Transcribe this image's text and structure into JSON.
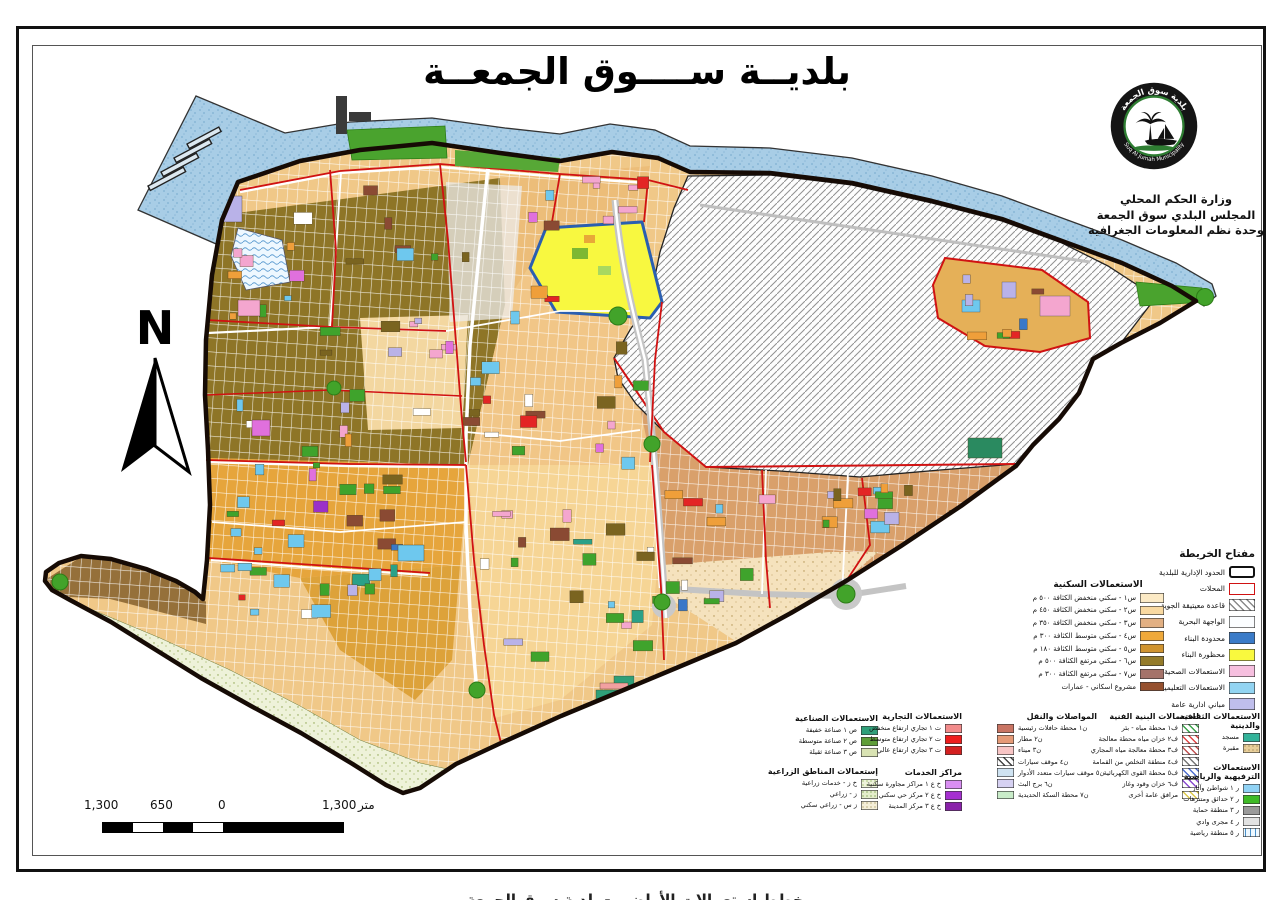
{
  "title": "بلديــة ســــوق الجمعــة",
  "logo": {
    "ring_text_top": "بلدية سوق الجمعة",
    "ring_text_bottom": "Suq Al Jumah Municipality"
  },
  "org": {
    "lines": [
      "وزارة الحكم المحلي",
      "المجلس البلدي سوق الجمعة",
      "وحدة نظم المعلومات الجغرافية"
    ]
  },
  "north_label": "N",
  "scale_bar": {
    "labels": [
      "1,300",
      "650",
      "0",
      "1,300"
    ],
    "unit": "متر"
  },
  "bottom_caption": "مخطط استعمالات الأراضي - بلدية سوق الجمعة",
  "map_colors": {
    "sea": "#a8cde6",
    "boundary": "#160b05",
    "quarter_line": "#d01212",
    "restricted_yellow": "#f8f840",
    "limited_blue": "#2b5fb0",
    "patch_palette": [
      "#6ec8ee",
      "#f4a6cf",
      "#3fa32c",
      "#b9b2e8",
      "#e070dd",
      "#e32525",
      "#8a4a33",
      "#7a6420",
      "#ffffff",
      "#2aa188",
      "#3a78c8",
      "#9b30c8",
      "#ef9f3a"
    ],
    "patch_weights": [
      20,
      12,
      17,
      6,
      4,
      6,
      8,
      6,
      6,
      3,
      3,
      2,
      7
    ]
  },
  "legend": {
    "key": {
      "title": "مفتاح الخريطة",
      "items": [
        {
          "label": "الحدود الإدارية للبلدية",
          "sw": {
            "t": "thick",
            "c": "#111111"
          }
        },
        {
          "label": "المحلات",
          "sw": {
            "t": "outline",
            "c": "#d01212"
          }
        },
        {
          "label": "قاعدة معيتيقة الجوية",
          "sw": {
            "t": "hatch",
            "c": "#8a8a8a"
          }
        },
        {
          "label": "الواجهة البحرية",
          "sw": {
            "t": "fill",
            "c": "#fbfdff"
          }
        },
        {
          "label": "محدودة البناء",
          "sw": {
            "t": "fill",
            "c": "#3a7bc8"
          }
        },
        {
          "label": "محظورة البناء",
          "sw": {
            "t": "fill",
            "c": "#f9f93e"
          }
        },
        {
          "label": "الاستعمالات الصحية",
          "sw": {
            "t": "fill",
            "c": "#f6bfdf"
          }
        },
        {
          "label": "الاستعمالات التعليمية",
          "sw": {
            "t": "fill",
            "c": "#92d4f2"
          }
        },
        {
          "label": "مباني ادارية عامة",
          "sw": {
            "t": "fill",
            "c": "#bfbeec"
          }
        }
      ]
    },
    "residential": {
      "title": "الاستعمالات السكنية",
      "items": [
        {
          "label": "س١ - سكني منخفض الكثافة ٥٠٠ م",
          "sw": {
            "t": "fill",
            "c": "#fceac5"
          }
        },
        {
          "label": "س٢ - سكني منخفض الكثافة ٤٥٠ م",
          "sw": {
            "t": "fill",
            "c": "#f9d9a1"
          }
        },
        {
          "label": "س٣ - سكني منخفض الكثافة ٣٥٠ م",
          "sw": {
            "t": "fill",
            "c": "#e2b083"
          }
        },
        {
          "label": "س٤ - سكني متوسط الكثافة ٣٠٠ م",
          "sw": {
            "t": "fill",
            "c": "#efa93b"
          }
        },
        {
          "label": "س٥ - سكني متوسط الكثافة ١٨٠ م",
          "sw": {
            "t": "fill",
            "c": "#d09430"
          }
        },
        {
          "label": "س٦ - سكني مرتفع الكثافة ٥٠٠ م",
          "sw": {
            "t": "fill",
            "c": "#947b2a"
          }
        },
        {
          "label": "س٧ - سكني مرتفع الكثافة ٣٠٠ م",
          "sw": {
            "t": "fill",
            "c": "#a5736a"
          }
        },
        {
          "label": "مشروع اسكاني - عمارات",
          "sw": {
            "t": "fill",
            "c": "#96512f"
          }
        }
      ]
    },
    "industrial": {
      "title": "الاستعمالات الصناعية",
      "items": [
        {
          "label": "ص ١  صناعة خفيفة",
          "sw": {
            "t": "fill",
            "c": "#2f9f79"
          }
        },
        {
          "label": "ص ٢  صناعة متوسطة",
          "sw": {
            "t": "fill",
            "c": "#5f9e38"
          }
        },
        {
          "label": "ص ٣  صناعة ثقيلة",
          "sw": {
            "t": "fill",
            "c": "#d9e3b3"
          }
        }
      ]
    },
    "agriculture": {
      "title": "إستعمالات المناطق الزراعية",
      "items": [
        {
          "label": "خ ز - خدمات زراعية",
          "sw": {
            "t": "stipple",
            "c": "#eef3da",
            "d": "#7aa83c"
          }
        },
        {
          "label": "ز - زراعي",
          "sw": {
            "t": "stipple",
            "c": "#e4eecb",
            "d": "#5c8c2c"
          }
        },
        {
          "label": "ز س - زراعي سكني",
          "sw": {
            "t": "stipple",
            "c": "#f5efd8",
            "d": "#9a8a4a"
          }
        }
      ]
    },
    "commercial": {
      "title": "الاستعمالات التجارية",
      "items": [
        {
          "label": "ت ١ تجاري ارتفاع منخفض",
          "sw": {
            "t": "fill",
            "c": "#f28b8b"
          }
        },
        {
          "label": "ت ٢ تجاري ارتفاع متوسط",
          "sw": {
            "t": "fill",
            "c": "#ee1c1c"
          }
        },
        {
          "label": "ت ٣ تجاري ارتفاع عالي",
          "sw": {
            "t": "fill",
            "c": "#d42020"
          }
        }
      ]
    },
    "services": {
      "title": "مراكز الخدمات",
      "items": [
        {
          "label": "خ ع ١  مراكز مجاورة سكنية",
          "sw": {
            "t": "fill",
            "c": "#d98ef2"
          }
        },
        {
          "label": "خ ع ٢  مركز حي سكني",
          "sw": {
            "t": "fill",
            "c": "#a52fd0"
          }
        },
        {
          "label": "خ ع ٣  مركز المدينة",
          "sw": {
            "t": "fill",
            "c": "#8a22aa"
          }
        }
      ]
    },
    "transport": {
      "title": "المواصلات والنقل",
      "swatch_left": true,
      "items": [
        {
          "label": "ن١ محطة حافلات رئيسية",
          "sw": {
            "t": "fill",
            "c": "#c97463"
          }
        },
        {
          "label": "ن٢ مطار",
          "sw": {
            "t": "fill",
            "c": "#e59a77"
          }
        },
        {
          "label": "ن٣ ميناء",
          "sw": {
            "t": "fill",
            "c": "#f8c5c5"
          }
        },
        {
          "label": "ن٤ موقف سيارات",
          "sw": {
            "t": "hatch",
            "c": "#444444"
          }
        },
        {
          "label": "ن٥ موقف سيارات متعدد الأدوار",
          "sw": {
            "t": "fill",
            "c": "#cfe3f2"
          }
        },
        {
          "label": "ن٦ برج البث",
          "sw": {
            "t": "fill",
            "c": "#d6d1f2"
          }
        },
        {
          "label": "ن٧ محطة السكة الحديدية",
          "sw": {
            "t": "fill",
            "c": "#c9ecc9"
          }
        }
      ]
    },
    "infrastructure": {
      "title": "استعمالات البنية الفنية",
      "items": [
        {
          "label": "ف١  محطة مياه - بئر",
          "sw": {
            "t": "hatch",
            "c": "#3aa34a"
          }
        },
        {
          "label": "ف٢  خزان مياه محطة معالجة",
          "sw": {
            "t": "hatch",
            "c": "#e04444"
          }
        },
        {
          "label": "ف٣ محطة معالجة مياه المجاري",
          "sw": {
            "t": "hatch",
            "c": "#c05050"
          }
        },
        {
          "label": "ف٤ منطقة التخلص من القمامة",
          "sw": {
            "t": "hatch",
            "c": "#787878"
          }
        },
        {
          "label": "ف٥ محطة القوى الكهربائية",
          "sw": {
            "t": "hatch",
            "c": "#4f6fd0"
          }
        },
        {
          "label": "ف٦ خزان وقود وغاز",
          "sw": {
            "t": "hatch",
            "c": "#8a4ad0"
          }
        },
        {
          "label": "مرافق عامة أخرى",
          "sw": {
            "t": "hatch",
            "c": "#ddca4a"
          }
        }
      ]
    },
    "cultural": {
      "title": "الاستعمالات الثقافية والدينية",
      "items": [
        {
          "label": "مسجد",
          "sw": {
            "t": "fill",
            "c": "#33b39a"
          }
        },
        {
          "label": "مقبرة",
          "sw": {
            "t": "stipple",
            "c": "#e9cf9a",
            "d": "#8a7340"
          }
        }
      ]
    },
    "recreation": {
      "title": "الاستعمالات الترفيهية والرياضية",
      "items": [
        {
          "label": "ر ١  شواطئ وآثار",
          "sw": {
            "t": "fill",
            "c": "#90d2f4"
          }
        },
        {
          "label": "ر ٢  حدائق ومتنزهات",
          "sw": {
            "t": "fill",
            "c": "#3fbb27"
          }
        },
        {
          "label": "ر ٣  منطقة حماية",
          "sw": {
            "t": "fill",
            "c": "#9a9a9a"
          }
        },
        {
          "label": "ر ٤  مجرى وادي",
          "sw": {
            "t": "fill",
            "c": "#e2e2e2"
          }
        },
        {
          "label": "ر ٥  منطقة رياضية",
          "sw": {
            "t": "wave",
            "c": "#4a90c8"
          }
        }
      ]
    }
  }
}
